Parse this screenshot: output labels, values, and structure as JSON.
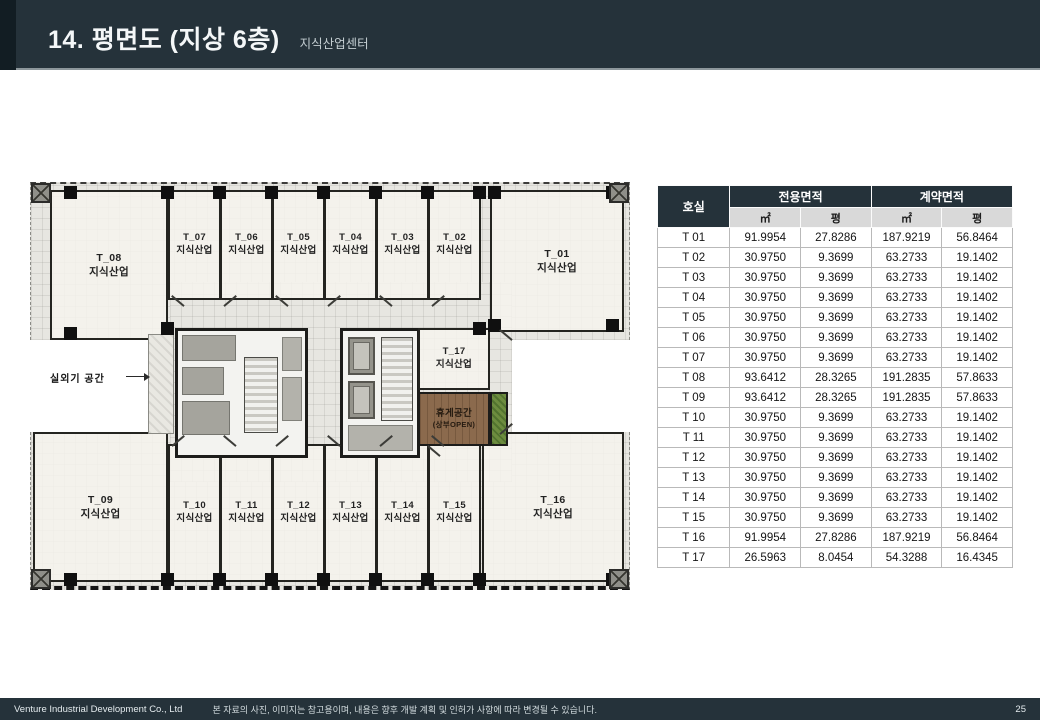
{
  "header": {
    "title": "14. 평면도 (지상 6층)",
    "subtitle": "지식산업센터"
  },
  "plan": {
    "rooms": {
      "t01": {
        "id": "T_01",
        "type": "지식산업"
      },
      "t02": {
        "id": "T_02",
        "type": "지식산업"
      },
      "t03": {
        "id": "T_03",
        "type": "지식산업"
      },
      "t04": {
        "id": "T_04",
        "type": "지식산업"
      },
      "t05": {
        "id": "T_05",
        "type": "지식산업"
      },
      "t06": {
        "id": "T_06",
        "type": "지식산업"
      },
      "t07": {
        "id": "T_07",
        "type": "지식산업"
      },
      "t08": {
        "id": "T_08",
        "type": "지식산업"
      },
      "t09": {
        "id": "T_09",
        "type": "지식산업"
      },
      "t10": {
        "id": "T_10",
        "type": "지식산업"
      },
      "t11": {
        "id": "T_11",
        "type": "지식산업"
      },
      "t12": {
        "id": "T_12",
        "type": "지식산업"
      },
      "t13": {
        "id": "T_13",
        "type": "지식산업"
      },
      "t14": {
        "id": "T_14",
        "type": "지식산업"
      },
      "t15": {
        "id": "T_15",
        "type": "지식산업"
      },
      "t16": {
        "id": "T_16",
        "type": "지식산업"
      },
      "t17": {
        "id": "T_17",
        "type": "지식산업"
      }
    },
    "annotations": {
      "outdoor_unit": "실외기 공간",
      "rest_area": "휴게공간",
      "rest_area_sub": "(상부OPEN)"
    }
  },
  "table": {
    "col_room": "호실",
    "group_exclusive": "전용면적",
    "group_contract": "계약면적",
    "unit_m2": "㎡",
    "unit_py": "평",
    "rows": [
      {
        "no": "T 01",
        "em2": "91.9954",
        "epy": "27.8286",
        "cm2": "187.9219",
        "cpy": "56.8464"
      },
      {
        "no": "T 02",
        "em2": "30.9750",
        "epy": "9.3699",
        "cm2": "63.2733",
        "cpy": "19.1402"
      },
      {
        "no": "T 03",
        "em2": "30.9750",
        "epy": "9.3699",
        "cm2": "63.2733",
        "cpy": "19.1402"
      },
      {
        "no": "T 04",
        "em2": "30.9750",
        "epy": "9.3699",
        "cm2": "63.2733",
        "cpy": "19.1402"
      },
      {
        "no": "T 05",
        "em2": "30.9750",
        "epy": "9.3699",
        "cm2": "63.2733",
        "cpy": "19.1402"
      },
      {
        "no": "T 06",
        "em2": "30.9750",
        "epy": "9.3699",
        "cm2": "63.2733",
        "cpy": "19.1402"
      },
      {
        "no": "T 07",
        "em2": "30.9750",
        "epy": "9.3699",
        "cm2": "63.2733",
        "cpy": "19.1402"
      },
      {
        "no": "T 08",
        "em2": "93.6412",
        "epy": "28.3265",
        "cm2": "191.2835",
        "cpy": "57.8633"
      },
      {
        "no": "T 09",
        "em2": "93.6412",
        "epy": "28.3265",
        "cm2": "191.2835",
        "cpy": "57.8633"
      },
      {
        "no": "T 10",
        "em2": "30.9750",
        "epy": "9.3699",
        "cm2": "63.2733",
        "cpy": "19.1402"
      },
      {
        "no": "T 11",
        "em2": "30.9750",
        "epy": "9.3699",
        "cm2": "63.2733",
        "cpy": "19.1402"
      },
      {
        "no": "T 12",
        "em2": "30.9750",
        "epy": "9.3699",
        "cm2": "63.2733",
        "cpy": "19.1402"
      },
      {
        "no": "T 13",
        "em2": "30.9750",
        "epy": "9.3699",
        "cm2": "63.2733",
        "cpy": "19.1402"
      },
      {
        "no": "T 14",
        "em2": "30.9750",
        "epy": "9.3699",
        "cm2": "63.2733",
        "cpy": "19.1402"
      },
      {
        "no": "T 15",
        "em2": "30.9750",
        "epy": "9.3699",
        "cm2": "63.2733",
        "cpy": "19.1402"
      },
      {
        "no": "T 16",
        "em2": "91.9954",
        "epy": "27.8286",
        "cm2": "187.9219",
        "cpy": "56.8464"
      },
      {
        "no": "T 17",
        "em2": "26.5963",
        "epy": "8.0454",
        "cm2": "54.3288",
        "cpy": "16.4345"
      }
    ]
  },
  "footer": {
    "company": "Venture Industrial Development Co., Ltd",
    "disclaimer": "본 자료의 사진, 이미지는 참고용이며, 내용은 향후 개발 계획 및 인허가 사항에 따라 변경될 수 있습니다.",
    "page": "25"
  },
  "colors": {
    "header_bg": "#25323a",
    "accent_strip": "#121d23",
    "table_header_bg": "#25323a",
    "table_subheader_bg": "#d9d9d9",
    "wall": "#1c1c1a",
    "floor": "#e7e6e1",
    "wood_rest_area": "#8b6a4d",
    "plant_strip": "#6d8c3f"
  }
}
